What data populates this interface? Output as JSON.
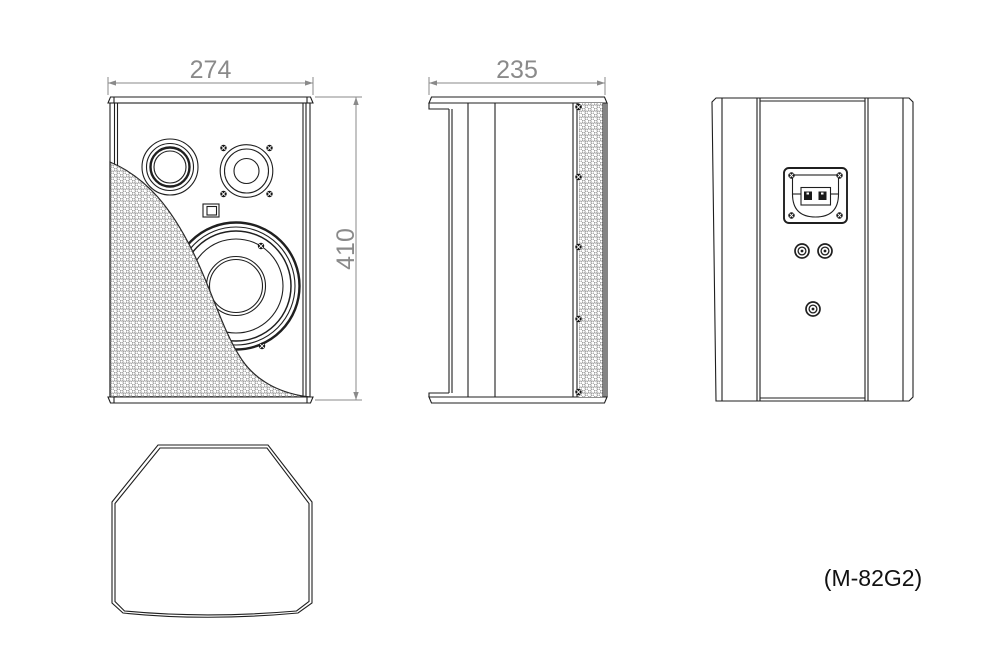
{
  "drawing": {
    "model_label": "(M-82G2)",
    "dimensions": {
      "front_width": "274",
      "front_height": "410",
      "side_depth": "235"
    },
    "colors": {
      "line": "#1f1f1f",
      "dimension": "#8a8a8a",
      "mesh_dot": "#8f8f8f",
      "screw_fill": "#151515",
      "background": "#ffffff"
    }
  }
}
